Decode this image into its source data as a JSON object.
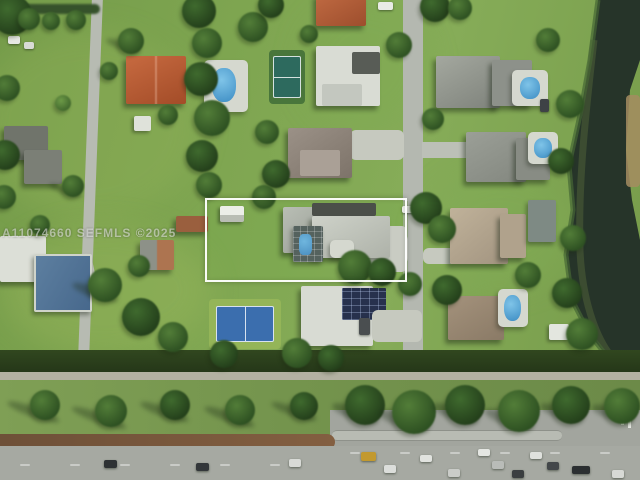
{
  "scene": {
    "type": "aerial-real-estate-photo",
    "description": "Aerial drone view of a suburban neighborhood; subject lot outlined in white, lake at right, highway at bottom",
    "watermark": "A11074660 SEFMLS ©2025",
    "trees": [
      {
        "x": -8,
        "y": -5,
        "s": 40,
        "t": 0
      },
      {
        "x": 18,
        "y": 8,
        "s": 22,
        "t": 1
      },
      {
        "x": 42,
        "y": 12,
        "s": 18,
        "t": 1
      },
      {
        "x": 66,
        "y": 10,
        "s": 20,
        "t": 1
      },
      {
        "x": 118,
        "y": 28,
        "s": 26,
        "t": 1,
        "sh": 18
      },
      {
        "x": -6,
        "y": 75,
        "s": 26,
        "t": 1
      },
      {
        "x": -10,
        "y": 140,
        "s": 30,
        "t": 0
      },
      {
        "x": -8,
        "y": 185,
        "s": 24,
        "t": 1
      },
      {
        "x": 55,
        "y": 95,
        "s": 16,
        "t": 2
      },
      {
        "x": 100,
        "y": 62,
        "s": 18,
        "t": 1
      },
      {
        "x": 158,
        "y": 105,
        "s": 20,
        "t": 1
      },
      {
        "x": 62,
        "y": 175,
        "s": 22,
        "t": 1,
        "sh": 20
      },
      {
        "x": 30,
        "y": 215,
        "s": 20,
        "t": 1
      },
      {
        "x": 182,
        "y": -6,
        "s": 34,
        "t": 0
      },
      {
        "x": 192,
        "y": 28,
        "s": 30,
        "t": 1
      },
      {
        "x": 184,
        "y": 62,
        "s": 34,
        "t": 0
      },
      {
        "x": 194,
        "y": 100,
        "s": 36,
        "t": 1
      },
      {
        "x": 186,
        "y": 140,
        "s": 32,
        "t": 0
      },
      {
        "x": 196,
        "y": 172,
        "s": 26,
        "t": 1
      },
      {
        "x": 238,
        "y": 12,
        "s": 30,
        "t": 1
      },
      {
        "x": 258,
        "y": -8,
        "s": 26,
        "t": 0
      },
      {
        "x": 300,
        "y": 25,
        "s": 18,
        "t": 1
      },
      {
        "x": 255,
        "y": 120,
        "s": 24,
        "t": 1
      },
      {
        "x": 262,
        "y": 160,
        "s": 28,
        "t": 0
      },
      {
        "x": 252,
        "y": 185,
        "s": 24,
        "t": 1
      },
      {
        "x": 386,
        "y": 32,
        "s": 26,
        "t": 1
      },
      {
        "x": 420,
        "y": -8,
        "s": 30,
        "t": 0
      },
      {
        "x": 448,
        "y": -4,
        "s": 24,
        "t": 1
      },
      {
        "x": 422,
        "y": 108,
        "s": 22,
        "t": 1
      },
      {
        "x": 338,
        "y": 250,
        "s": 34,
        "t": 1
      },
      {
        "x": 368,
        "y": 258,
        "s": 28,
        "t": 0
      },
      {
        "x": 398,
        "y": 272,
        "s": 24,
        "t": 1
      },
      {
        "x": 410,
        "y": 192,
        "s": 32,
        "t": 0
      },
      {
        "x": 428,
        "y": 215,
        "s": 28,
        "t": 1
      },
      {
        "x": 536,
        "y": 28,
        "s": 24,
        "t": 1
      },
      {
        "x": 556,
        "y": 90,
        "s": 28,
        "t": 1
      },
      {
        "x": 548,
        "y": 148,
        "s": 26,
        "t": 0
      },
      {
        "x": 560,
        "y": 225,
        "s": 26,
        "t": 1
      },
      {
        "x": 552,
        "y": 278,
        "s": 30,
        "t": 0
      },
      {
        "x": 566,
        "y": 318,
        "s": 32,
        "t": 1
      },
      {
        "x": 515,
        "y": 262,
        "s": 26,
        "t": 1
      },
      {
        "x": 432,
        "y": 275,
        "s": 30,
        "t": 0
      },
      {
        "x": 88,
        "y": 268,
        "s": 34,
        "t": 1,
        "sh": 24
      },
      {
        "x": 122,
        "y": 298,
        "s": 38,
        "t": 0
      },
      {
        "x": 158,
        "y": 322,
        "s": 30,
        "t": 1
      },
      {
        "x": 210,
        "y": 340,
        "s": 28,
        "t": 0
      },
      {
        "x": 282,
        "y": 338,
        "s": 30,
        "t": 1
      },
      {
        "x": 318,
        "y": 345,
        "s": 26,
        "t": 0
      },
      {
        "x": 128,
        "y": 255,
        "s": 22,
        "t": 1
      },
      {
        "x": 30,
        "y": 390,
        "s": 30,
        "t": 1,
        "sh": 34
      },
      {
        "x": 95,
        "y": 395,
        "s": 32,
        "t": 1,
        "sh": 36
      },
      {
        "x": 160,
        "y": 390,
        "s": 30,
        "t": 0,
        "sh": 30
      },
      {
        "x": 225,
        "y": 395,
        "s": 30,
        "t": 1,
        "sh": 32
      },
      {
        "x": 290,
        "y": 392,
        "s": 28,
        "t": 0,
        "sh": 28
      },
      {
        "x": 345,
        "y": 385,
        "s": 40,
        "t": 0,
        "sh": 20
      },
      {
        "x": 392,
        "y": 390,
        "s": 44,
        "t": 1,
        "sh": 22
      },
      {
        "x": 445,
        "y": 385,
        "s": 40,
        "t": 0,
        "sh": 20
      },
      {
        "x": 498,
        "y": 390,
        "s": 42,
        "t": 1,
        "sh": 22
      },
      {
        "x": 552,
        "y": 386,
        "s": 38,
        "t": 0,
        "sh": 18
      },
      {
        "x": 604,
        "y": 388,
        "s": 36,
        "t": 1,
        "sh": 18
      }
    ],
    "cars": [
      {
        "x": 378,
        "y": 2,
        "w": 15,
        "h": 8,
        "c": "#e9ebe5"
      },
      {
        "x": 8,
        "y": 36,
        "w": 12,
        "h": 8,
        "c": "#e6e8e3"
      },
      {
        "x": 24,
        "y": 42,
        "w": 10,
        "h": 7,
        "c": "#d9dbd6"
      },
      {
        "x": 402,
        "y": 206,
        "w": 12,
        "h": 7,
        "c": "#eceee9"
      },
      {
        "x": 540,
        "y": 99,
        "w": 9,
        "h": 13,
        "c": "#3e4246"
      },
      {
        "x": 359,
        "y": 318,
        "w": 11,
        "h": 17,
        "c": "#4a4e50"
      },
      {
        "x": 104,
        "y": 460,
        "w": 13,
        "h": 8,
        "c": "#2e3234"
      },
      {
        "x": 196,
        "y": 463,
        "w": 13,
        "h": 8,
        "c": "#33373a"
      },
      {
        "x": 289,
        "y": 459,
        "w": 12,
        "h": 8,
        "c": "#d8dad6"
      },
      {
        "x": 361,
        "y": 452,
        "w": 15,
        "h": 9,
        "c": "#c2992f"
      },
      {
        "x": 384,
        "y": 465,
        "w": 12,
        "h": 8,
        "c": "#dcdedb"
      },
      {
        "x": 420,
        "y": 455,
        "w": 12,
        "h": 7,
        "c": "#e1e3df"
      },
      {
        "x": 448,
        "y": 469,
        "w": 12,
        "h": 8,
        "c": "#caccc8"
      },
      {
        "x": 478,
        "y": 449,
        "w": 12,
        "h": 7,
        "c": "#e4e6e2"
      },
      {
        "x": 492,
        "y": 461,
        "w": 12,
        "h": 8,
        "c": "#b9bcb8"
      },
      {
        "x": 512,
        "y": 470,
        "w": 12,
        "h": 8,
        "c": "#3a3e40"
      },
      {
        "x": 530,
        "y": 452,
        "w": 12,
        "h": 7,
        "c": "#dfe1dd"
      },
      {
        "x": 547,
        "y": 462,
        "w": 12,
        "h": 8,
        "c": "#43474a"
      },
      {
        "x": 572,
        "y": 466,
        "w": 18,
        "h": 8,
        "c": "#2b2f31"
      },
      {
        "x": 612,
        "y": 470,
        "w": 12,
        "h": 8,
        "c": "#d7d9d5"
      }
    ]
  },
  "colors": {
    "highlight_border": "#ffffff",
    "grass": "#7aa24e",
    "water_dark": "#243127",
    "road_gray": "#b4b8b0",
    "red_roof": "#b85c36",
    "pool_blue": "#3c8cc3",
    "court_blue": "#3b6eae",
    "court_teal": "#2d6a5e",
    "dirt_median": "#7a5a40"
  }
}
